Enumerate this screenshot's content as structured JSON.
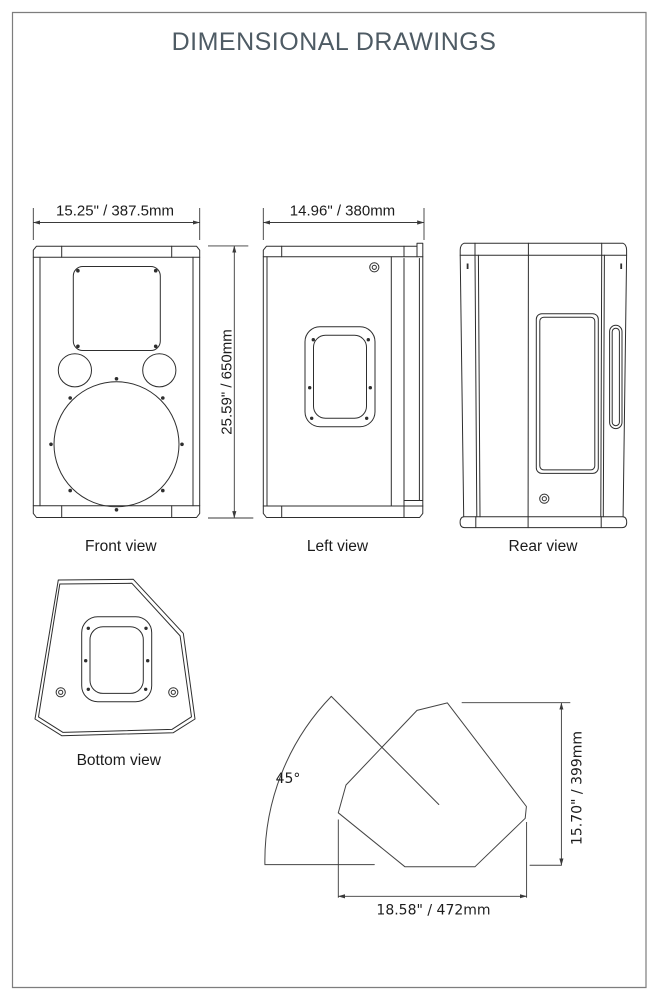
{
  "page": {
    "title": "DIMENSIONAL DRAWINGS"
  },
  "views": {
    "front": {
      "label": "Front view",
      "width_dim": "15.25\" / 387.5mm",
      "height_dim": "25.59\" / 650mm"
    },
    "left": {
      "label": "Left view",
      "width_dim": "14.96\" / 380mm"
    },
    "rear": {
      "label": "Rear view"
    },
    "bottom": {
      "label": "Bottom view"
    },
    "monitor": {
      "angle": "45°",
      "height_dim": "15.70\" / 399mm",
      "width_dim": "18.58\" / 472mm"
    }
  },
  "colors": {
    "title": "#4e5b64",
    "drawing_line": "#2e2e2e",
    "page_border": "#7d7d7d",
    "background": "#ffffff"
  }
}
